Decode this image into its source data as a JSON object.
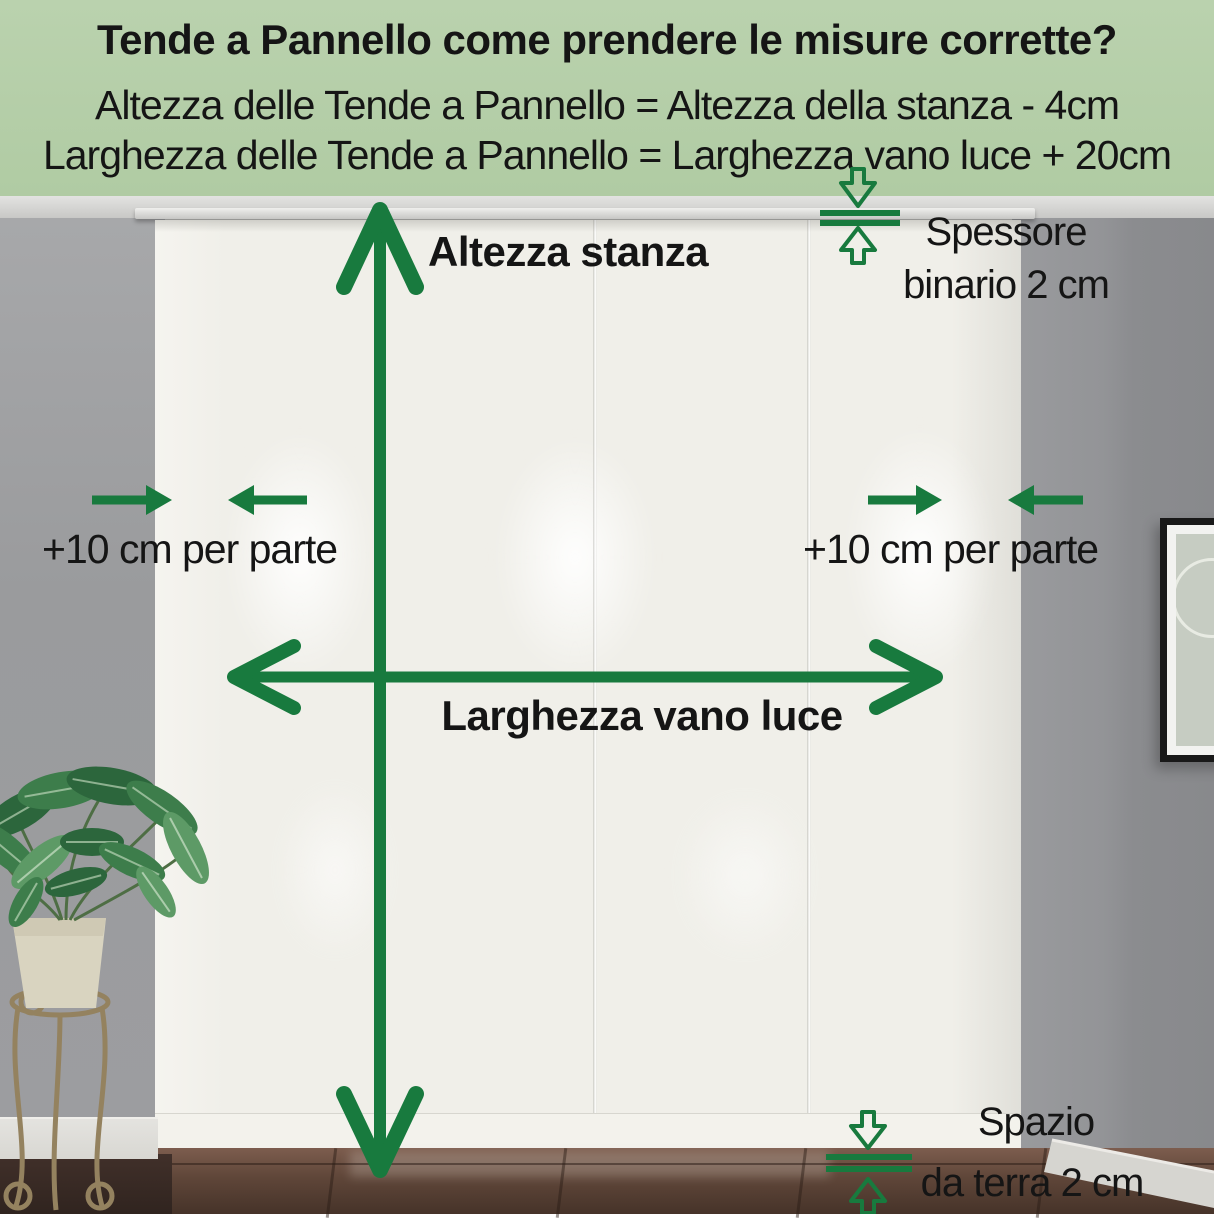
{
  "colors": {
    "accent_green": "#187a3e",
    "header_bg_top": "#bad2ae",
    "header_bg_bottom": "#b0cba3",
    "ink": "#151515",
    "wall_left": "#9a9b9d",
    "wall_right": "#8f9093",
    "curtain": "#f0efe9",
    "baseboard": "#d8d7d2"
  },
  "header": {
    "title": "Tende a Pannello come prendere le misure corrette?",
    "formula_height": "Altezza delle Tende a Pannello = Altezza della stanza - 4cm",
    "formula_width": "Larghezza delle Tende a Pannello = Larghezza vano luce + 20cm"
  },
  "annotations": {
    "room_height": "Altezza stanza",
    "opening_width": "Larghezza vano luce",
    "side_allowance_left": "+10 cm per parte",
    "side_allowance_right": "+10 cm per parte",
    "track_thickness_line1": "Spessore",
    "track_thickness_line2": "binario 2 cm",
    "floor_gap_line1": "Spazio",
    "floor_gap_line2": "da terra 2 cm"
  },
  "scene": {
    "curtain_panels": 4
  }
}
